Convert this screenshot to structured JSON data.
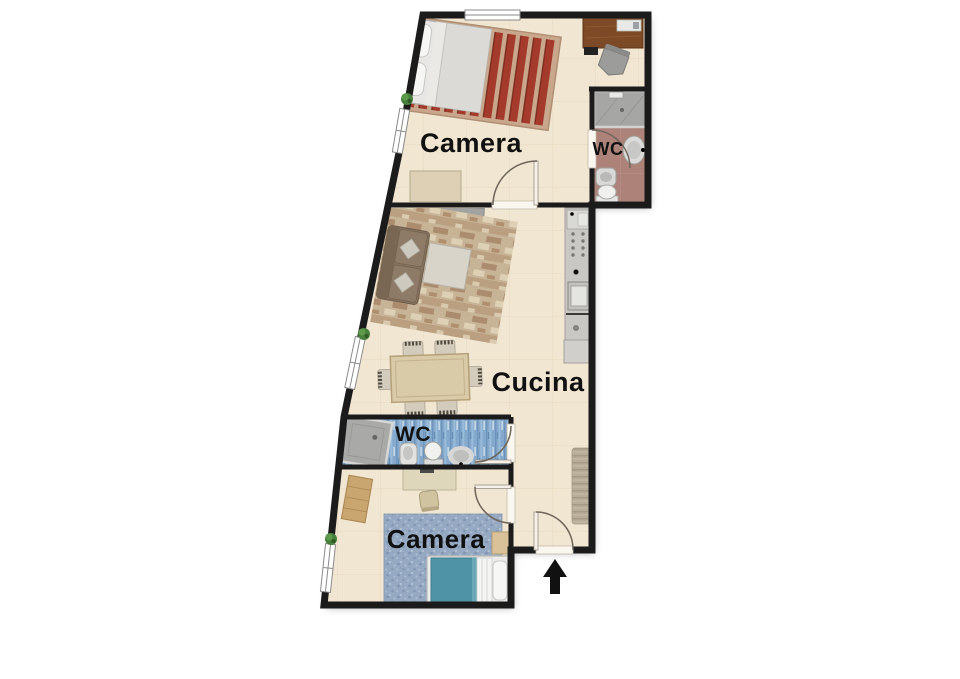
{
  "floorplan": {
    "kind": "apartment floor plan",
    "labels": {
      "bedroom_top": "Camera",
      "wc_top": "WC",
      "kitchen_living": "Cucina",
      "wc_bottom": "WC",
      "bedroom_bottom": "Camera"
    },
    "icons": {
      "entrance_arrow": "solid-up-arrow",
      "plant": "potted-plant",
      "door_swing": "quarter-circle-arc"
    },
    "colors": {
      "wall": "#1b1b1b",
      "floor_tile": "#f1e6d1",
      "wc_top_floor": "#ad8379",
      "wc_bottom_floor": "#84a9cc",
      "bedroom_rug_red": "#a43a2b",
      "bedroom_rug_blue": "#96a9c2",
      "bed_duvet_teal": "#4f93a6",
      "desk_wood": "#7c4a26",
      "plant_green": "#3f7a33",
      "arrow_black": "#111111"
    }
  }
}
